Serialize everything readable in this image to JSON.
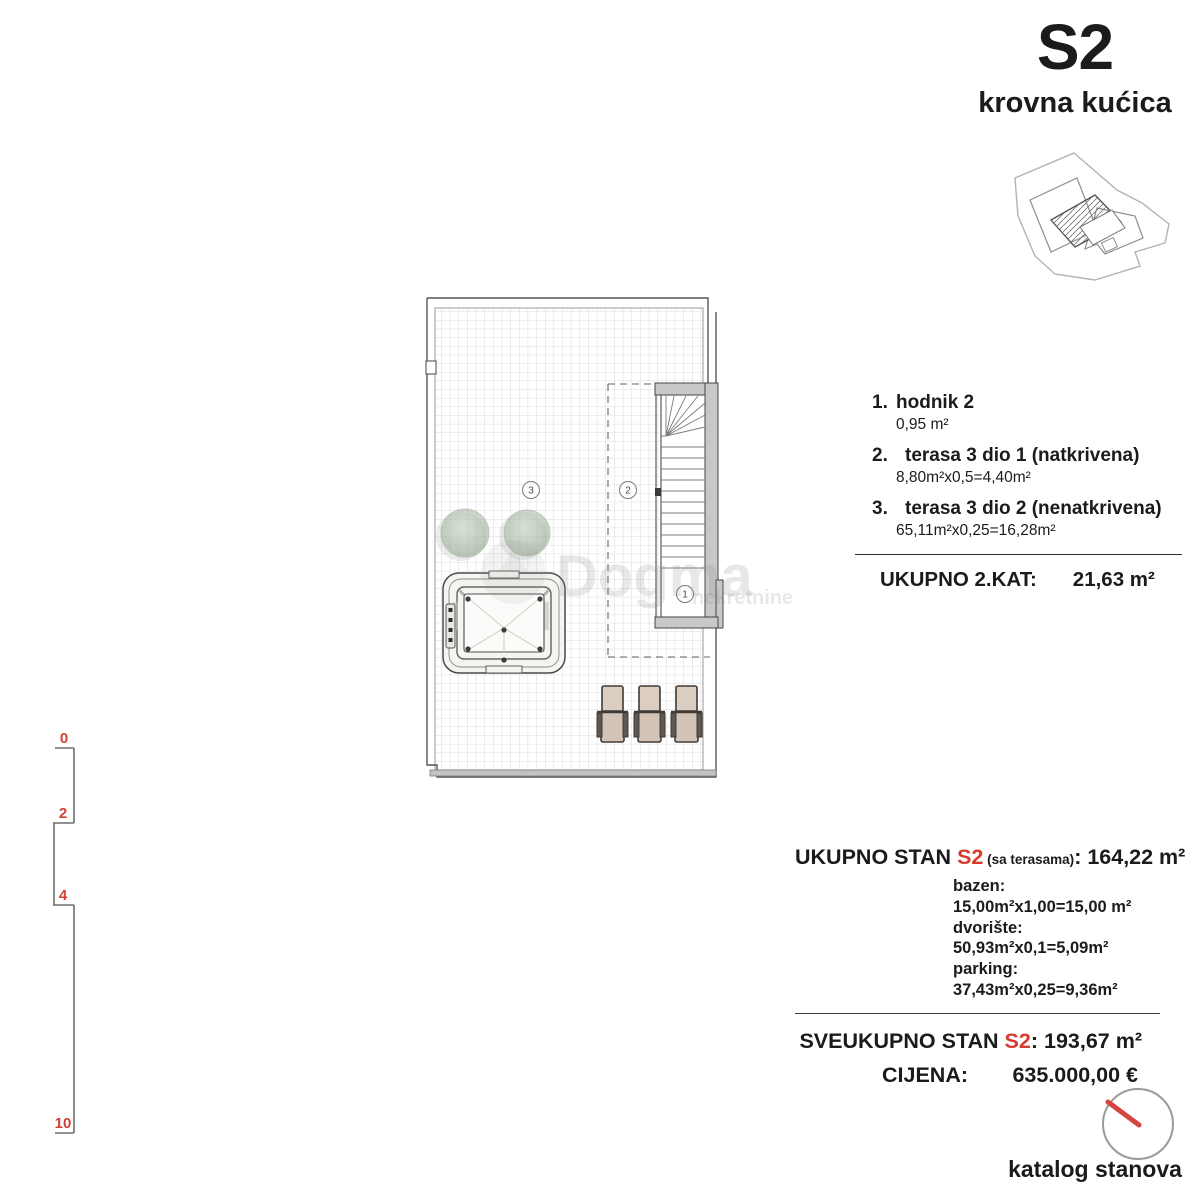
{
  "header": {
    "unit": "S2",
    "subtitle": "krovna kućica"
  },
  "legend": {
    "items": [
      {
        "num": "1.",
        "name": "hodnik 2",
        "calc": "0,95 m²"
      },
      {
        "num": "2.",
        "name": "terasa 3 dio 1 (natkrivena)",
        "calc": "8,80m²x0,5=4,40m²"
      },
      {
        "num": "3.",
        "name": "terasa 3 dio 2 (nenatkrivena)",
        "calc": "65,11m²x0,25=16,28m²"
      }
    ],
    "total_label": "UKUPNO 2.KAT:",
    "total_value": "21,63 m²"
  },
  "summary": {
    "line1_pre": "UKUPNO STAN ",
    "line1_unit": "S2",
    "line1_mid": " (sa terasama)",
    "line1_colon": ": ",
    "line1_value": "164,22 m²",
    "extras": [
      "bazen: 15,00m²x1,00=15,00 m²",
      "dvorište: 50,93m²x0,1=5,09m²",
      "parking: 37,43m²x0,25=9,36m²"
    ],
    "line2_pre": "SVEUKUPNO STAN ",
    "line2_unit": "S2",
    "line2_colon": ": ",
    "line2_value": "193,67 m²",
    "price_label": "CIJENA:",
    "price_value": "635.000,00 €"
  },
  "plan": {
    "marker_1": "1",
    "marker_2": "2",
    "marker_3": "3",
    "watermark": "Dogma",
    "watermark_sub": "nekretnine"
  },
  "scalebar": {
    "labels": [
      "0",
      "2",
      "4",
      "10"
    ]
  },
  "footer": {
    "caption": "katalog stanova"
  },
  "colors": {
    "accent_red": "#d93a2e",
    "wall_gray": "#c8c8c8",
    "grid_gray": "#d2d2d2",
    "lounger_tan": "#d9c9bd",
    "tree_green": "#a9bda4"
  }
}
